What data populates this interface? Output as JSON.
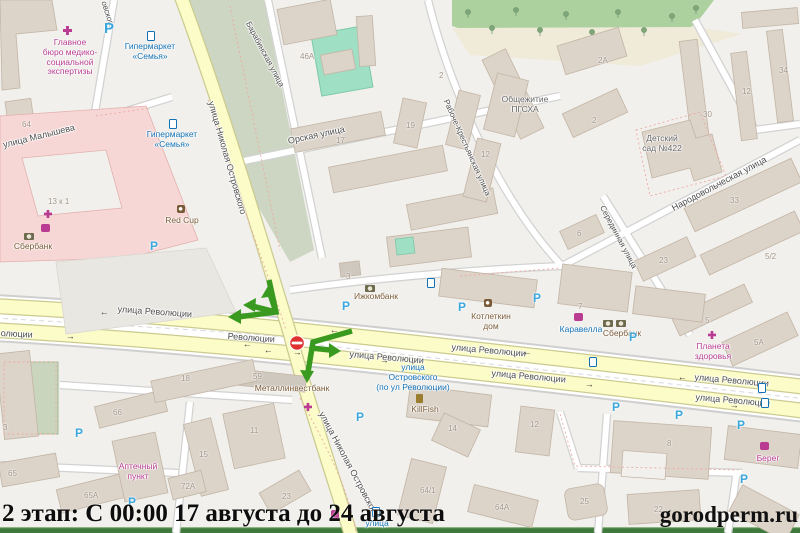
{
  "caption": {
    "text": "2 этап: С 00:00 17 августа до 24 августа"
  },
  "watermark": {
    "text": "gorodperm.ru"
  },
  "colors": {
    "detour_green": "#3a9a20",
    "no_entry_red": "#e03131",
    "parking_blue": "#3ba7de",
    "transit_blue": "#1271b5",
    "poi_magenta": "#b93c92",
    "poi_brown": "#7a5b37",
    "road_yellow": "#fcfcc9"
  },
  "map": {
    "parking_letter": "P",
    "arrow_left": "←",
    "arrow_right": "→",
    "street_labels": [
      {
        "t": "улица Малышева",
        "x": 2,
        "y": 140,
        "r": -14
      },
      {
        "t": "овского",
        "x": 108,
        "y": 0,
        "r": 72,
        "s": 8
      },
      {
        "t": "улица Николая Островского",
        "x": 216,
        "y": 100,
        "r": 74
      },
      {
        "t": "улица Николая Островского",
        "x": 326,
        "y": 410,
        "r": 62
      },
      {
        "t": "Барабинская улица",
        "x": 252,
        "y": 20,
        "r": 62,
        "s": 8
      },
      {
        "t": "Орская улица",
        "x": 287,
        "y": 136,
        "r": -12
      },
      {
        "t": "Рабоче-Крестьянская улица",
        "x": 450,
        "y": 98,
        "r": 66,
        "s": 8
      },
      {
        "t": "Народовольческая улица",
        "x": 670,
        "y": 204,
        "r": -28
      },
      {
        "t": "Серединная улица",
        "x": 606,
        "y": 204,
        "r": 62,
        "s": 8
      },
      {
        "t": "улица Революции",
        "x": 118,
        "y": 304,
        "r": 4
      },
      {
        "t": "Революции",
        "x": 228,
        "y": 331,
        "r": 4
      },
      {
        "t": "олюции",
        "x": 1,
        "y": 328,
        "r": 3
      },
      {
        "t": "улица Революции",
        "x": 350,
        "y": 349,
        "r": 5
      },
      {
        "t": "улица Революции",
        "x": 452,
        "y": 342,
        "r": 5
      },
      {
        "t": "улица Революции",
        "x": 492,
        "y": 368,
        "r": 5
      },
      {
        "t": "улица Революции",
        "x": 695,
        "y": 372,
        "r": 5
      },
      {
        "t": "улица Революции",
        "x": 696,
        "y": 392,
        "r": 5
      }
    ],
    "poi_labels": [
      {
        "t": "Главное\nбюро медико-\nсоциальной\nэкспертизы",
        "cx": 70,
        "y": 38,
        "c": "mag"
      },
      {
        "t": "Гипермаркет\n«Семья»",
        "cx": 150,
        "y": 42,
        "c": "blu"
      },
      {
        "t": "Гипермаркет\n«Семья»",
        "cx": 172,
        "y": 130,
        "c": "blu"
      },
      {
        "t": "Red Cup",
        "cx": 182,
        "y": 216,
        "c": "brn"
      },
      {
        "t": "Сбербанк",
        "cx": 33,
        "y": 242,
        "c": "brn"
      },
      {
        "t": "Ижкомбанк",
        "cx": 376,
        "y": 292,
        "c": "brn"
      },
      {
        "t": "Котлеткин\nдом",
        "cx": 491,
        "y": 312,
        "c": "brn"
      },
      {
        "t": "Каравелла",
        "cx": 581,
        "y": 325,
        "c": "blu"
      },
      {
        "t": "Сбербанк",
        "cx": 622,
        "y": 329,
        "c": "brn"
      },
      {
        "t": "Планета\nздоровья",
        "cx": 713,
        "y": 342,
        "c": "mag"
      },
      {
        "t": "Металлинвестбанк",
        "cx": 292,
        "y": 384,
        "c": "brn"
      },
      {
        "t": "Аптечный\nпункт",
        "cx": 138,
        "y": 462,
        "c": "mag"
      },
      {
        "t": "KillFish",
        "cx": 425,
        "y": 405,
        "c": "brn"
      },
      {
        "t": "Берег",
        "cx": 768,
        "y": 454,
        "c": "mag"
      },
      {
        "t": "Общежитие\nПГСХА",
        "cx": 525,
        "y": 95,
        "c": "gry2"
      },
      {
        "t": "Детский\nсад №422",
        "cx": 662,
        "y": 134,
        "c": "gry2"
      },
      {
        "t": "улица\nОстровского\n(по ул Революции)",
        "cx": 413,
        "y": 363,
        "c": "blu"
      },
      {
        "t": "улица",
        "cx": 377,
        "y": 519,
        "c": "blu"
      }
    ],
    "house_numbers": [
      {
        "t": "64",
        "x": 22,
        "y": 120
      },
      {
        "t": "13 к 1",
        "x": 48,
        "y": 197
      },
      {
        "t": "46А",
        "x": 300,
        "y": 52
      },
      {
        "t": "17",
        "x": 336,
        "y": 136
      },
      {
        "t": "19",
        "x": 406,
        "y": 121
      },
      {
        "t": "2",
        "x": 439,
        "y": 71
      },
      {
        "t": "2А",
        "x": 598,
        "y": 56
      },
      {
        "t": "2",
        "x": 592,
        "y": 116
      },
      {
        "t": "12",
        "x": 481,
        "y": 150
      },
      {
        "t": "30",
        "x": 703,
        "y": 110
      },
      {
        "t": "12",
        "x": 742,
        "y": 87
      },
      {
        "t": "34",
        "x": 779,
        "y": 66
      },
      {
        "t": "33",
        "x": 730,
        "y": 196
      },
      {
        "t": "23",
        "x": 659,
        "y": 256
      },
      {
        "t": "6",
        "x": 577,
        "y": 229
      },
      {
        "t": "5/2",
        "x": 765,
        "y": 252
      },
      {
        "t": "5",
        "x": 705,
        "y": 316
      },
      {
        "t": "5А",
        "x": 754,
        "y": 338
      },
      {
        "t": "3",
        "x": 346,
        "y": 272
      },
      {
        "t": "7",
        "x": 578,
        "y": 302
      },
      {
        "t": "59",
        "x": 253,
        "y": 372
      },
      {
        "t": "3",
        "x": 3,
        "y": 423
      },
      {
        "t": "65",
        "x": 8,
        "y": 469
      },
      {
        "t": "65А",
        "x": 84,
        "y": 491
      },
      {
        "t": "66",
        "x": 113,
        "y": 408
      },
      {
        "t": "18",
        "x": 181,
        "y": 374
      },
      {
        "t": "15",
        "x": 199,
        "y": 450
      },
      {
        "t": "72А",
        "x": 181,
        "y": 482
      },
      {
        "t": "11",
        "x": 250,
        "y": 426
      },
      {
        "t": "23",
        "x": 282,
        "y": 492
      },
      {
        "t": "14",
        "x": 448,
        "y": 424
      },
      {
        "t": "64/1",
        "x": 420,
        "y": 486
      },
      {
        "t": "64А",
        "x": 495,
        "y": 503
      },
      {
        "t": "8",
        "x": 667,
        "y": 439
      },
      {
        "t": "22",
        "x": 654,
        "y": 505
      },
      {
        "t": "25",
        "x": 580,
        "y": 497
      },
      {
        "t": "12",
        "x": 530,
        "y": 420
      }
    ],
    "parking": [
      {
        "x": 104,
        "y": 20,
        "s": 15
      },
      {
        "x": 150,
        "y": 239
      },
      {
        "x": 342,
        "y": 299
      },
      {
        "x": 458,
        "y": 300
      },
      {
        "x": 533,
        "y": 291
      },
      {
        "x": 629,
        "y": 330
      },
      {
        "x": 612,
        "y": 400
      },
      {
        "x": 675,
        "y": 408
      },
      {
        "x": 737,
        "y": 418
      },
      {
        "x": 740,
        "y": 472
      },
      {
        "x": 356,
        "y": 410
      },
      {
        "x": 75,
        "y": 426
      },
      {
        "x": 128,
        "y": 495
      }
    ],
    "transit_icons": [
      {
        "x": 147,
        "y": 31
      },
      {
        "x": 169,
        "y": 119
      },
      {
        "x": 589,
        "y": 357
      },
      {
        "x": 758,
        "y": 383
      },
      {
        "x": 761,
        "y": 398
      },
      {
        "x": 372,
        "y": 507
      },
      {
        "x": 427,
        "y": 278
      }
    ],
    "poi_icons": [
      {
        "k": "med",
        "x": 63,
        "y": 26
      },
      {
        "k": "pharm",
        "x": 44,
        "y": 210
      },
      {
        "k": "cart",
        "x": 41,
        "y": 224
      },
      {
        "k": "bank",
        "x": 24,
        "y": 233
      },
      {
        "k": "cafe",
        "x": 177,
        "y": 205
      },
      {
        "k": "bank",
        "x": 365,
        "y": 285
      },
      {
        "k": "cafe",
        "x": 484,
        "y": 299
      },
      {
        "k": "cart",
        "x": 574,
        "y": 313
      },
      {
        "k": "bank",
        "x": 603,
        "y": 320
      },
      {
        "k": "bank",
        "x": 616,
        "y": 320
      },
      {
        "k": "pharm",
        "x": 708,
        "y": 331
      },
      {
        "k": "goblet",
        "x": 416,
        "y": 394
      },
      {
        "k": "cart",
        "x": 760,
        "y": 442
      },
      {
        "k": "pharm",
        "x": 304,
        "y": 403
      },
      {
        "k": "shop",
        "x": 331,
        "y": 510
      }
    ],
    "road_arrows": [
      {
        "x": 100,
        "y": 308,
        "d": "l"
      },
      {
        "x": 330,
        "y": 326,
        "d": "l"
      },
      {
        "x": 523,
        "y": 348,
        "d": "l"
      },
      {
        "x": 678,
        "y": 373,
        "d": "l"
      },
      {
        "x": 66,
        "y": 332,
        "d": "r"
      },
      {
        "x": 293,
        "y": 348,
        "d": "r"
      },
      {
        "x": 380,
        "y": 356,
        "d": "r"
      },
      {
        "x": 585,
        "y": 380,
        "d": "r"
      },
      {
        "x": 730,
        "y": 401,
        "d": "r"
      },
      {
        "x": 243,
        "y": 340,
        "d": "l"
      },
      {
        "x": 264,
        "y": 346,
        "d": "l"
      }
    ]
  }
}
